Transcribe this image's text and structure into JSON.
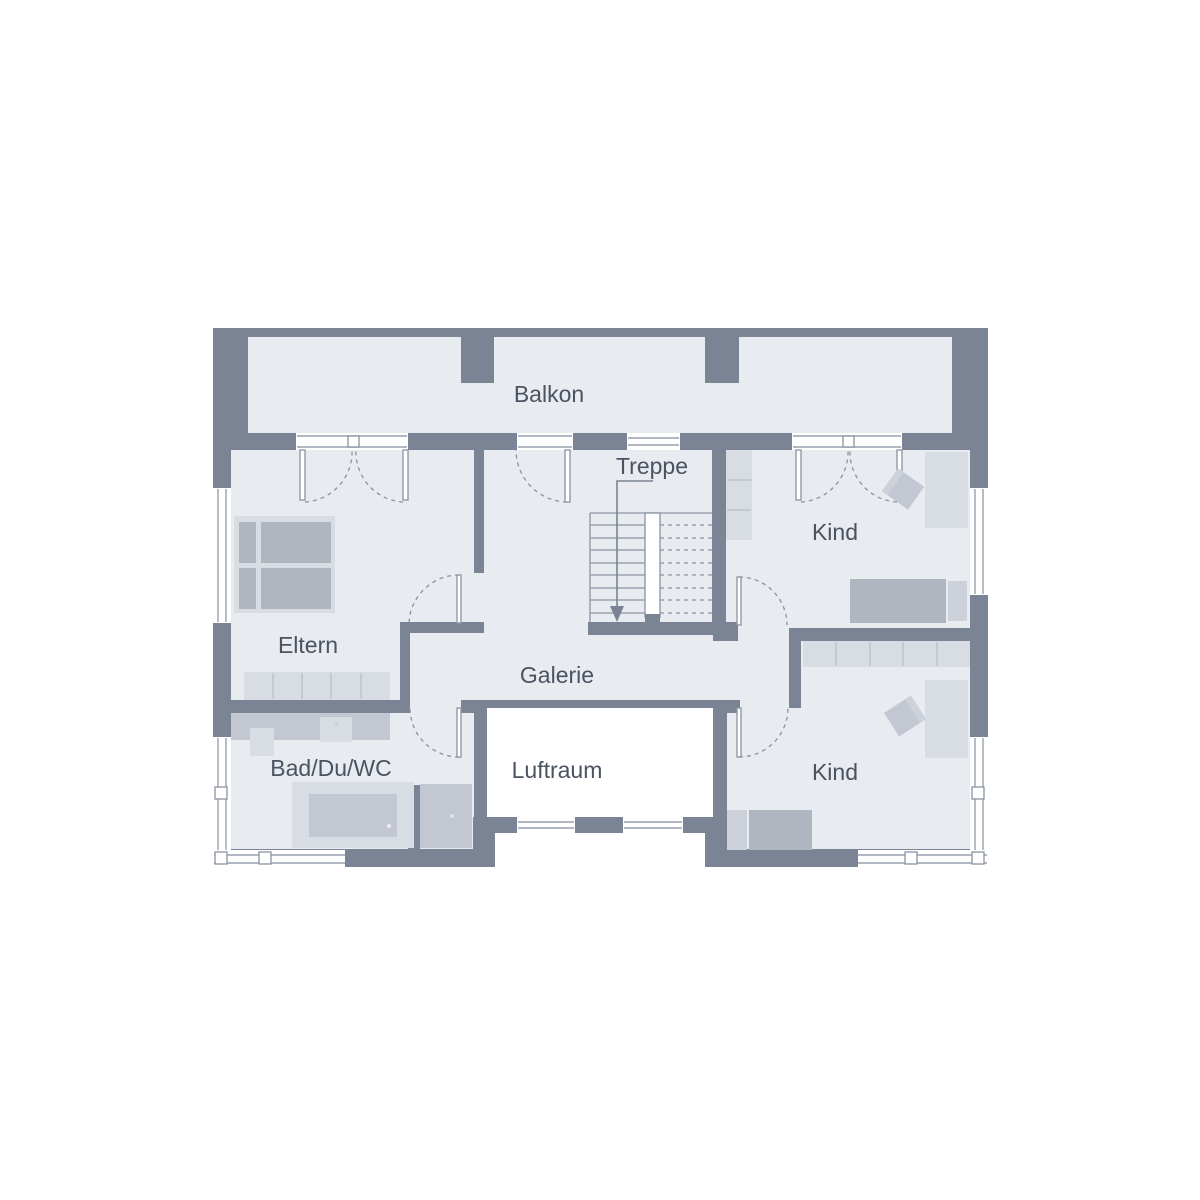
{
  "plan": {
    "labels": {
      "balkon": "Balkon",
      "treppe": "Treppe",
      "kind_top": "Kind",
      "kind_bottom": "Kind",
      "eltern": "Eltern",
      "galerie": "Galerie",
      "bad": "Bad/Du/WC",
      "luftraum": "Luftraum"
    },
    "colors": {
      "wall": "#7b8495",
      "floor": "#e8ebf0",
      "furniture_light": "#d8dce3",
      "furniture_medium": "#b0b6c0",
      "window_line": "#98a1af",
      "text": "#4b5260",
      "background": "#ffffff"
    }
  }
}
